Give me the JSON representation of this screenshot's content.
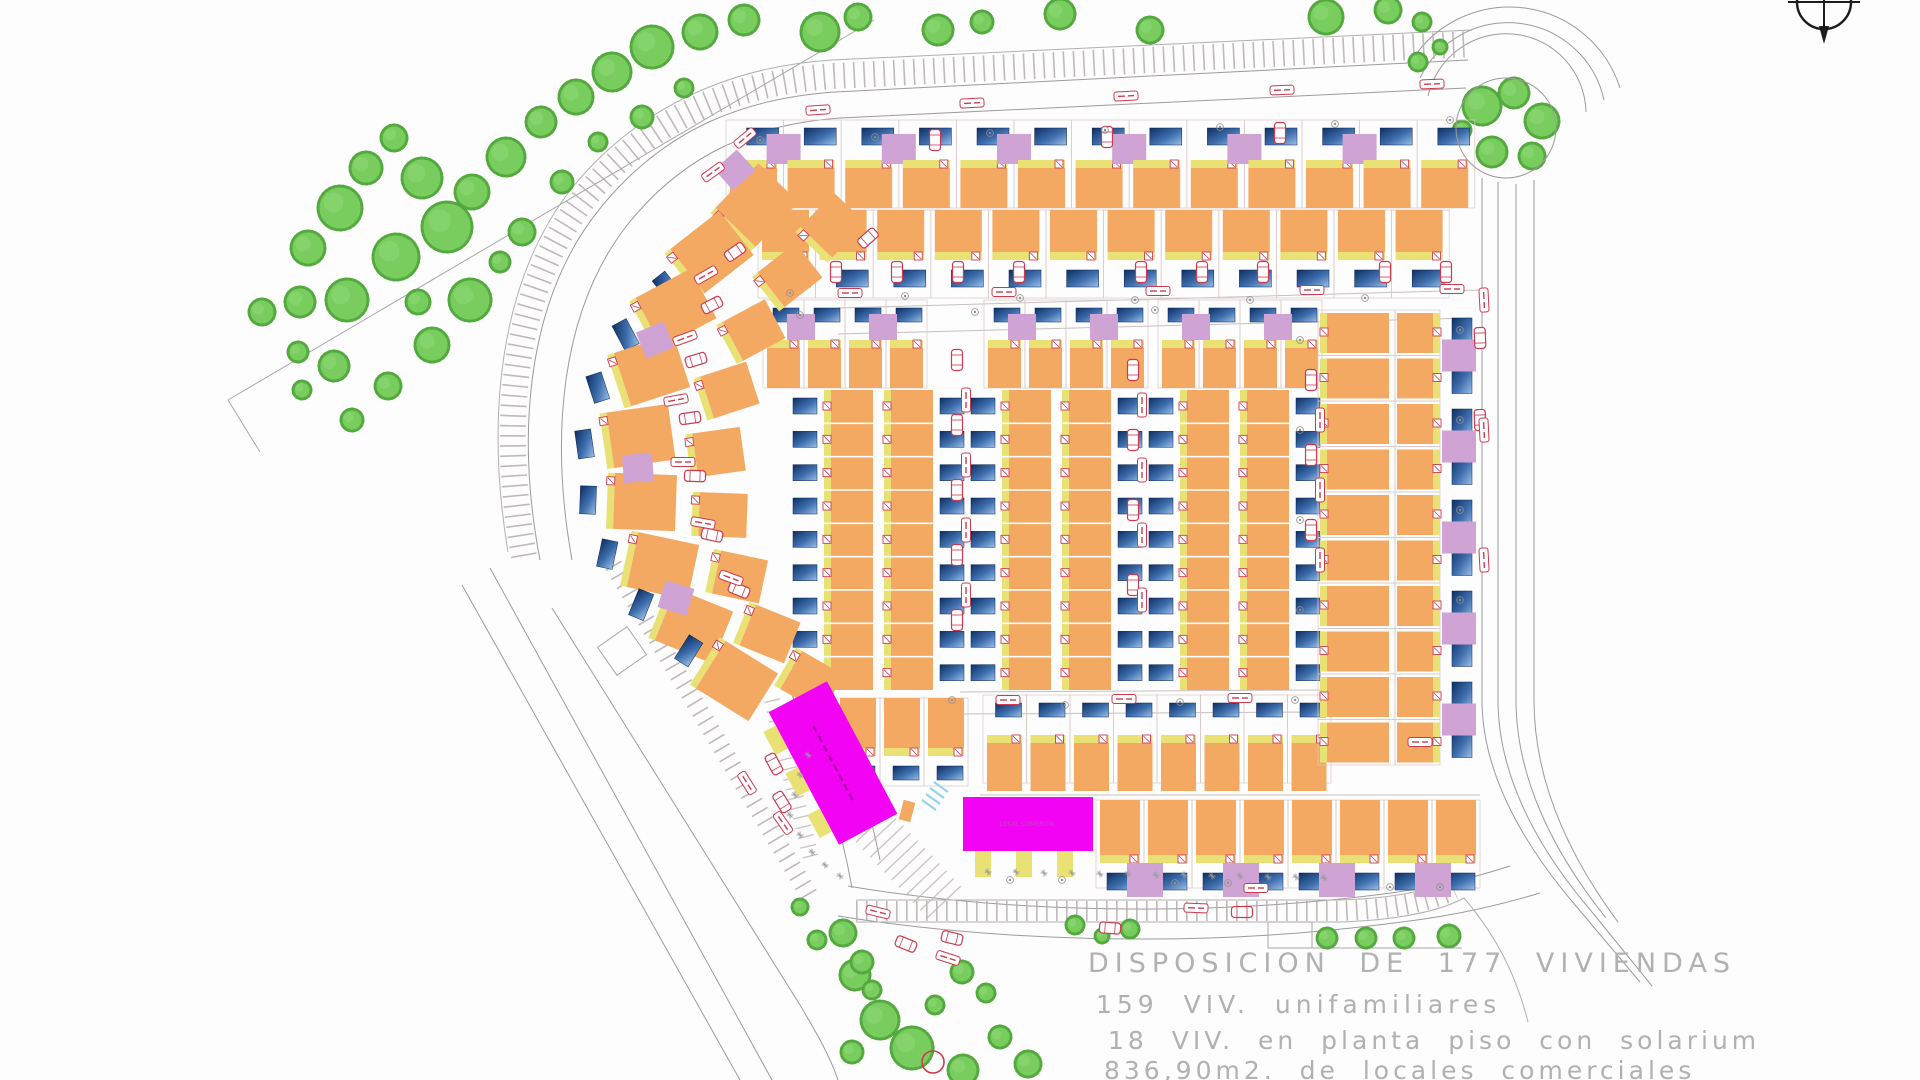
{
  "annotation": {
    "line1": "DISPOSICION DE 177 VIVIENDAS",
    "line2": "159 VIV. unifamiliares",
    "line3": "18 VIV. en planta piso con solarium",
    "line4": "836,90m2. de locales comerciales"
  },
  "commercial": {
    "block_a_label": "LOCAL COMERCIAL",
    "block_b_label": "LOCAL COMERCIAL"
  },
  "colors": {
    "house_orange": "#f4a963",
    "porch_yellow": "#e9e174",
    "garage_purple": "#cfa3d4",
    "pool_dark": "#0e2f63",
    "pool_mid": "#3f6fae",
    "pool_light": "#9cc0e8",
    "tree_green": "#79cd5f",
    "tree_edge": "#53a83e",
    "commercial_magenta": "#f303f3",
    "red_symbol": "#cc3a50",
    "road_line": "#9b9b9b",
    "plot_line": "#dcc6c6",
    "ladder": "#b6abab",
    "cyan_hatch": "#8fd4e8",
    "text_gray": "#b2b0b0"
  },
  "site": {
    "rows": [
      {
        "name": "row-top-1",
        "x": 726,
        "y": 120,
        "n": 13,
        "dx": 57.6,
        "w": 47,
        "h": 40,
        "face": "N",
        "garages": true,
        "pools": true
      },
      {
        "name": "row-top-2",
        "x": 758,
        "y": 210,
        "n": 12,
        "dx": 57.6,
        "w": 47,
        "h": 42,
        "face": "S",
        "garages": false,
        "pools": true
      },
      {
        "name": "row-cluster1-top",
        "x": 763,
        "y": 300,
        "n": 4,
        "dx": 41,
        "w": 33,
        "h": 40,
        "face": "N",
        "garages": true,
        "pools": true,
        "small": true
      },
      {
        "name": "row-cluster2-top",
        "x": 984,
        "y": 300,
        "n": 4,
        "dx": 41,
        "w": 33,
        "h": 40,
        "face": "N",
        "garages": true,
        "pools": true,
        "small": true
      },
      {
        "name": "row-cluster3-top",
        "x": 1158,
        "y": 300,
        "n": 4,
        "dx": 41,
        "w": 33,
        "h": 40,
        "face": "N",
        "garages": true,
        "pools": true,
        "small": true
      },
      {
        "name": "row-bottom-1",
        "x": 983,
        "y": 695,
        "n": 8,
        "dx": 43.5,
        "w": 35,
        "h": 48,
        "face": "N",
        "garages": false,
        "pools": true,
        "small": true
      },
      {
        "name": "row-bottom-2",
        "x": 1096,
        "y": 800,
        "n": 8,
        "dx": 48,
        "w": 40,
        "h": 55,
        "face": "S",
        "garages": true,
        "pools": true
      },
      {
        "name": "row-cluster1-bottom",
        "x": 836,
        "y": 698,
        "n": 3,
        "dx": 44,
        "w": 36,
        "h": 50,
        "face": "S",
        "garages": false,
        "pools": true,
        "small": true
      }
    ],
    "terraces": [
      {
        "xL": 793,
        "xA": 831,
        "xB": 891,
        "y": 390,
        "h": 300,
        "units": 9
      },
      {
        "xL": 971,
        "xA": 1009,
        "xB": 1069,
        "y": 390,
        "h": 300,
        "units": 9
      },
      {
        "xL": 1149,
        "xA": 1187,
        "xB": 1247,
        "y": 390,
        "h": 300,
        "units": 9
      }
    ],
    "right_cols": {
      "colL": {
        "x": 1318,
        "y": 310,
        "n": 10,
        "dy": 45.5
      },
      "colR": {
        "x": 1395,
        "y": 310,
        "n": 10,
        "dy": 45.5
      }
    },
    "arc_outer": [
      [
        757,
        205,
        -46
      ],
      [
        712,
        252,
        -38
      ],
      [
        676,
        308,
        -28
      ],
      [
        652,
        370,
        -18
      ],
      [
        641,
        436,
        -8
      ],
      [
        645,
        502,
        2
      ],
      [
        663,
        566,
        12
      ],
      [
        694,
        626,
        22
      ],
      [
        737,
        681,
        32
      ]
    ],
    "arc_inner": [
      [
        833,
        225,
        -46
      ],
      [
        790,
        275,
        -38
      ],
      [
        754,
        330,
        -28
      ],
      [
        730,
        390,
        -18
      ],
      [
        719,
        452,
        -8
      ],
      [
        723,
        515,
        2
      ],
      [
        740,
        577,
        12
      ],
      [
        770,
        634,
        22
      ],
      [
        812,
        682,
        30
      ]
    ],
    "arc_garages": [
      [
        735,
        170,
        -42
      ],
      [
        655,
        340,
        -22
      ],
      [
        638,
        468,
        -4
      ],
      [
        676,
        598,
        17
      ]
    ],
    "commercial_a": {
      "cx": 833,
      "cy": 763,
      "w": 66,
      "h": 150,
      "rot": -28
    },
    "commercial_b": {
      "x": 963,
      "y": 797,
      "w": 130,
      "h": 54
    },
    "trees": [
      [
        340,
        208,
        22
      ],
      [
        308,
        248,
        17
      ],
      [
        366,
        168,
        16
      ],
      [
        394,
        138,
        13
      ],
      [
        422,
        178,
        20
      ],
      [
        300,
        302,
        15
      ],
      [
        347,
        300,
        21
      ],
      [
        262,
        312,
        13
      ],
      [
        396,
        257,
        23
      ],
      [
        447,
        227,
        25
      ],
      [
        472,
        192,
        17
      ],
      [
        506,
        157,
        19
      ],
      [
        541,
        122,
        15
      ],
      [
        576,
        97,
        17
      ],
      [
        612,
        72,
        19
      ],
      [
        652,
        47,
        21
      ],
      [
        700,
        32,
        17
      ],
      [
        744,
        20,
        15
      ],
      [
        470,
        300,
        21
      ],
      [
        432,
        345,
        17
      ],
      [
        388,
        386,
        13
      ],
      [
        352,
        420,
        11
      ],
      [
        522,
        232,
        13
      ],
      [
        562,
        182,
        11
      ],
      [
        642,
        117,
        11
      ],
      [
        684,
        88,
        9
      ],
      [
        820,
        32,
        19
      ],
      [
        858,
        17,
        13
      ],
      [
        302,
        390,
        9
      ],
      [
        334,
        366,
        15
      ],
      [
        298,
        352,
        10
      ],
      [
        418,
        302,
        12
      ],
      [
        500,
        262,
        10
      ],
      [
        598,
        142,
        9
      ],
      [
        938,
        30,
        15
      ],
      [
        982,
        22,
        11
      ],
      [
        1060,
        14,
        15
      ],
      [
        1150,
        30,
        13
      ],
      [
        1326,
        17,
        17
      ],
      [
        1388,
        10,
        13
      ],
      [
        1422,
        22,
        9
      ],
      [
        1482,
        106,
        19
      ],
      [
        1514,
        93,
        15
      ],
      [
        1542,
        121,
        17
      ],
      [
        1492,
        152,
        15
      ],
      [
        1532,
        156,
        13
      ],
      [
        1462,
        130,
        9
      ],
      [
        1418,
        62,
        9
      ],
      [
        1440,
        47,
        7
      ],
      [
        855,
        975,
        15
      ],
      [
        880,
        1020,
        19
      ],
      [
        852,
        1052,
        11
      ],
      [
        912,
        1048,
        21
      ],
      [
        963,
        1070,
        15
      ],
      [
        1000,
        1037,
        11
      ],
      [
        1028,
        1064,
        13
      ],
      [
        800,
        907,
        8
      ],
      [
        817,
        940,
        9
      ],
      [
        843,
        933,
        13
      ],
      [
        862,
        962,
        11
      ],
      [
        872,
        990,
        9
      ],
      [
        962,
        972,
        11
      ],
      [
        986,
        993,
        9
      ],
      [
        935,
        1005,
        9
      ],
      [
        1075,
        925,
        9
      ],
      [
        1102,
        936,
        7
      ],
      [
        1130,
        929,
        9
      ],
      [
        1327,
        938,
        10
      ],
      [
        1366,
        938,
        10
      ],
      [
        1404,
        938,
        10
      ],
      [
        1449,
        936,
        11
      ]
    ],
    "cars": [
      [
        836,
        272,
        90
      ],
      [
        897,
        272,
        90
      ],
      [
        958,
        272,
        90
      ],
      [
        1019,
        272,
        90
      ],
      [
        1141,
        272,
        90
      ],
      [
        1202,
        272,
        90
      ],
      [
        1263,
        272,
        90
      ],
      [
        1385,
        272,
        90
      ],
      [
        1446,
        272,
        90
      ],
      [
        935,
        140,
        90
      ],
      [
        1107,
        137,
        90
      ],
      [
        1280,
        133,
        90
      ],
      [
        957,
        360,
        90
      ],
      [
        957,
        425,
        90
      ],
      [
        957,
        490,
        90
      ],
      [
        957,
        555,
        90
      ],
      [
        957,
        620,
        90
      ],
      [
        1133,
        370,
        90
      ],
      [
        1133,
        440,
        90
      ],
      [
        1133,
        510,
        90
      ],
      [
        1133,
        585,
        90
      ],
      [
        1311,
        380,
        90
      ],
      [
        1311,
        455,
        90
      ],
      [
        1311,
        530,
        90
      ],
      [
        735,
        252,
        -35
      ],
      [
        712,
        305,
        -27
      ],
      [
        696,
        360,
        -17
      ],
      [
        690,
        418,
        -8
      ],
      [
        695,
        476,
        2
      ],
      [
        712,
        535,
        12
      ],
      [
        739,
        590,
        22
      ],
      [
        782,
        802,
        58
      ],
      [
        774,
        764,
        62
      ],
      [
        868,
        238,
        -42
      ],
      [
        906,
        944,
        22
      ],
      [
        952,
        938,
        14
      ],
      [
        1110,
        928,
        4
      ],
      [
        1242,
        912,
        0
      ],
      [
        1480,
        338,
        88
      ],
      [
        1480,
        420,
        88
      ]
    ],
    "labels": [
      [
        818,
        110,
        -4
      ],
      [
        972,
        103,
        -3
      ],
      [
        1126,
        96,
        -3
      ],
      [
        1282,
        90,
        -2
      ],
      [
        1432,
        84,
        -2
      ],
      [
        850,
        293,
        0
      ],
      [
        1004,
        292,
        0
      ],
      [
        1158,
        291,
        0
      ],
      [
        1312,
        290,
        0
      ],
      [
        1452,
        289,
        0
      ],
      [
        966,
        400,
        90
      ],
      [
        966,
        465,
        90
      ],
      [
        966,
        530,
        90
      ],
      [
        966,
        595,
        90
      ],
      [
        1142,
        405,
        90
      ],
      [
        1142,
        470,
        90
      ],
      [
        1142,
        535,
        90
      ],
      [
        1142,
        600,
        90
      ],
      [
        1320,
        420,
        90
      ],
      [
        1320,
        490,
        90
      ],
      [
        1320,
        560,
        90
      ],
      [
        1008,
        700,
        0
      ],
      [
        1124,
        699,
        0
      ],
      [
        1240,
        698,
        0
      ],
      [
        706,
        275,
        -30
      ],
      [
        685,
        338,
        -20
      ],
      [
        676,
        400,
        -10
      ],
      [
        683,
        462,
        0
      ],
      [
        703,
        523,
        10
      ],
      [
        731,
        578,
        20
      ],
      [
        745,
        138,
        -40
      ],
      [
        713,
        172,
        -36
      ],
      [
        783,
        823,
        55
      ],
      [
        747,
        783,
        58
      ],
      [
        878,
        912,
        14
      ],
      [
        1256,
        888,
        0
      ],
      [
        948,
        958,
        18
      ],
      [
        1196,
        908,
        2
      ],
      [
        1420,
        742,
        0
      ],
      [
        1484,
        300,
        87
      ],
      [
        1484,
        430,
        87
      ],
      [
        1484,
        560,
        87
      ]
    ],
    "circle_symbols": [
      [
        760,
        140
      ],
      [
        875,
        137
      ],
      [
        990,
        133
      ],
      [
        1105,
        130
      ],
      [
        1220,
        127
      ],
      [
        1335,
        124
      ],
      [
        1450,
        120
      ],
      [
        790,
        293
      ],
      [
        905,
        296
      ],
      [
        1020,
        298
      ],
      [
        1135,
        300
      ],
      [
        1250,
        300
      ],
      [
        1365,
        298
      ],
      [
        800,
        315
      ],
      [
        975,
        312
      ],
      [
        1155,
        310
      ],
      [
        952,
        700
      ],
      [
        1065,
        705
      ],
      [
        1180,
        702
      ],
      [
        1295,
        700
      ],
      [
        1010,
        880
      ],
      [
        1062,
        880
      ],
      [
        1175,
        883
      ],
      [
        1228,
        883
      ],
      [
        1390,
        887
      ],
      [
        1440,
        887
      ],
      [
        1300,
        340
      ],
      [
        1300,
        430
      ],
      [
        1300,
        520
      ],
      [
        1300,
        610
      ],
      [
        1460,
        330
      ],
      [
        1460,
        420
      ],
      [
        1460,
        510
      ],
      [
        1460,
        600
      ]
    ],
    "people_marks": [
      [
        988,
        872
      ],
      [
        1016,
        872
      ],
      [
        1044,
        873
      ],
      [
        1072,
        873
      ],
      [
        1100,
        874
      ],
      [
        1128,
        874
      ],
      [
        1156,
        875
      ],
      [
        1184,
        875
      ],
      [
        1212,
        876
      ],
      [
        1240,
        876
      ],
      [
        1268,
        877
      ],
      [
        1296,
        877
      ],
      [
        1324,
        878
      ],
      [
        808,
        755
      ],
      [
        800,
        775
      ],
      [
        795,
        795
      ],
      [
        790,
        815
      ],
      [
        800,
        835
      ],
      [
        812,
        852
      ],
      [
        825,
        865
      ],
      [
        840,
        876
      ]
    ],
    "red_circle": [
      933,
      1062,
      11
    ],
    "roundabout": {
      "cx": 1506,
      "cy": 128,
      "r": 50
    }
  }
}
